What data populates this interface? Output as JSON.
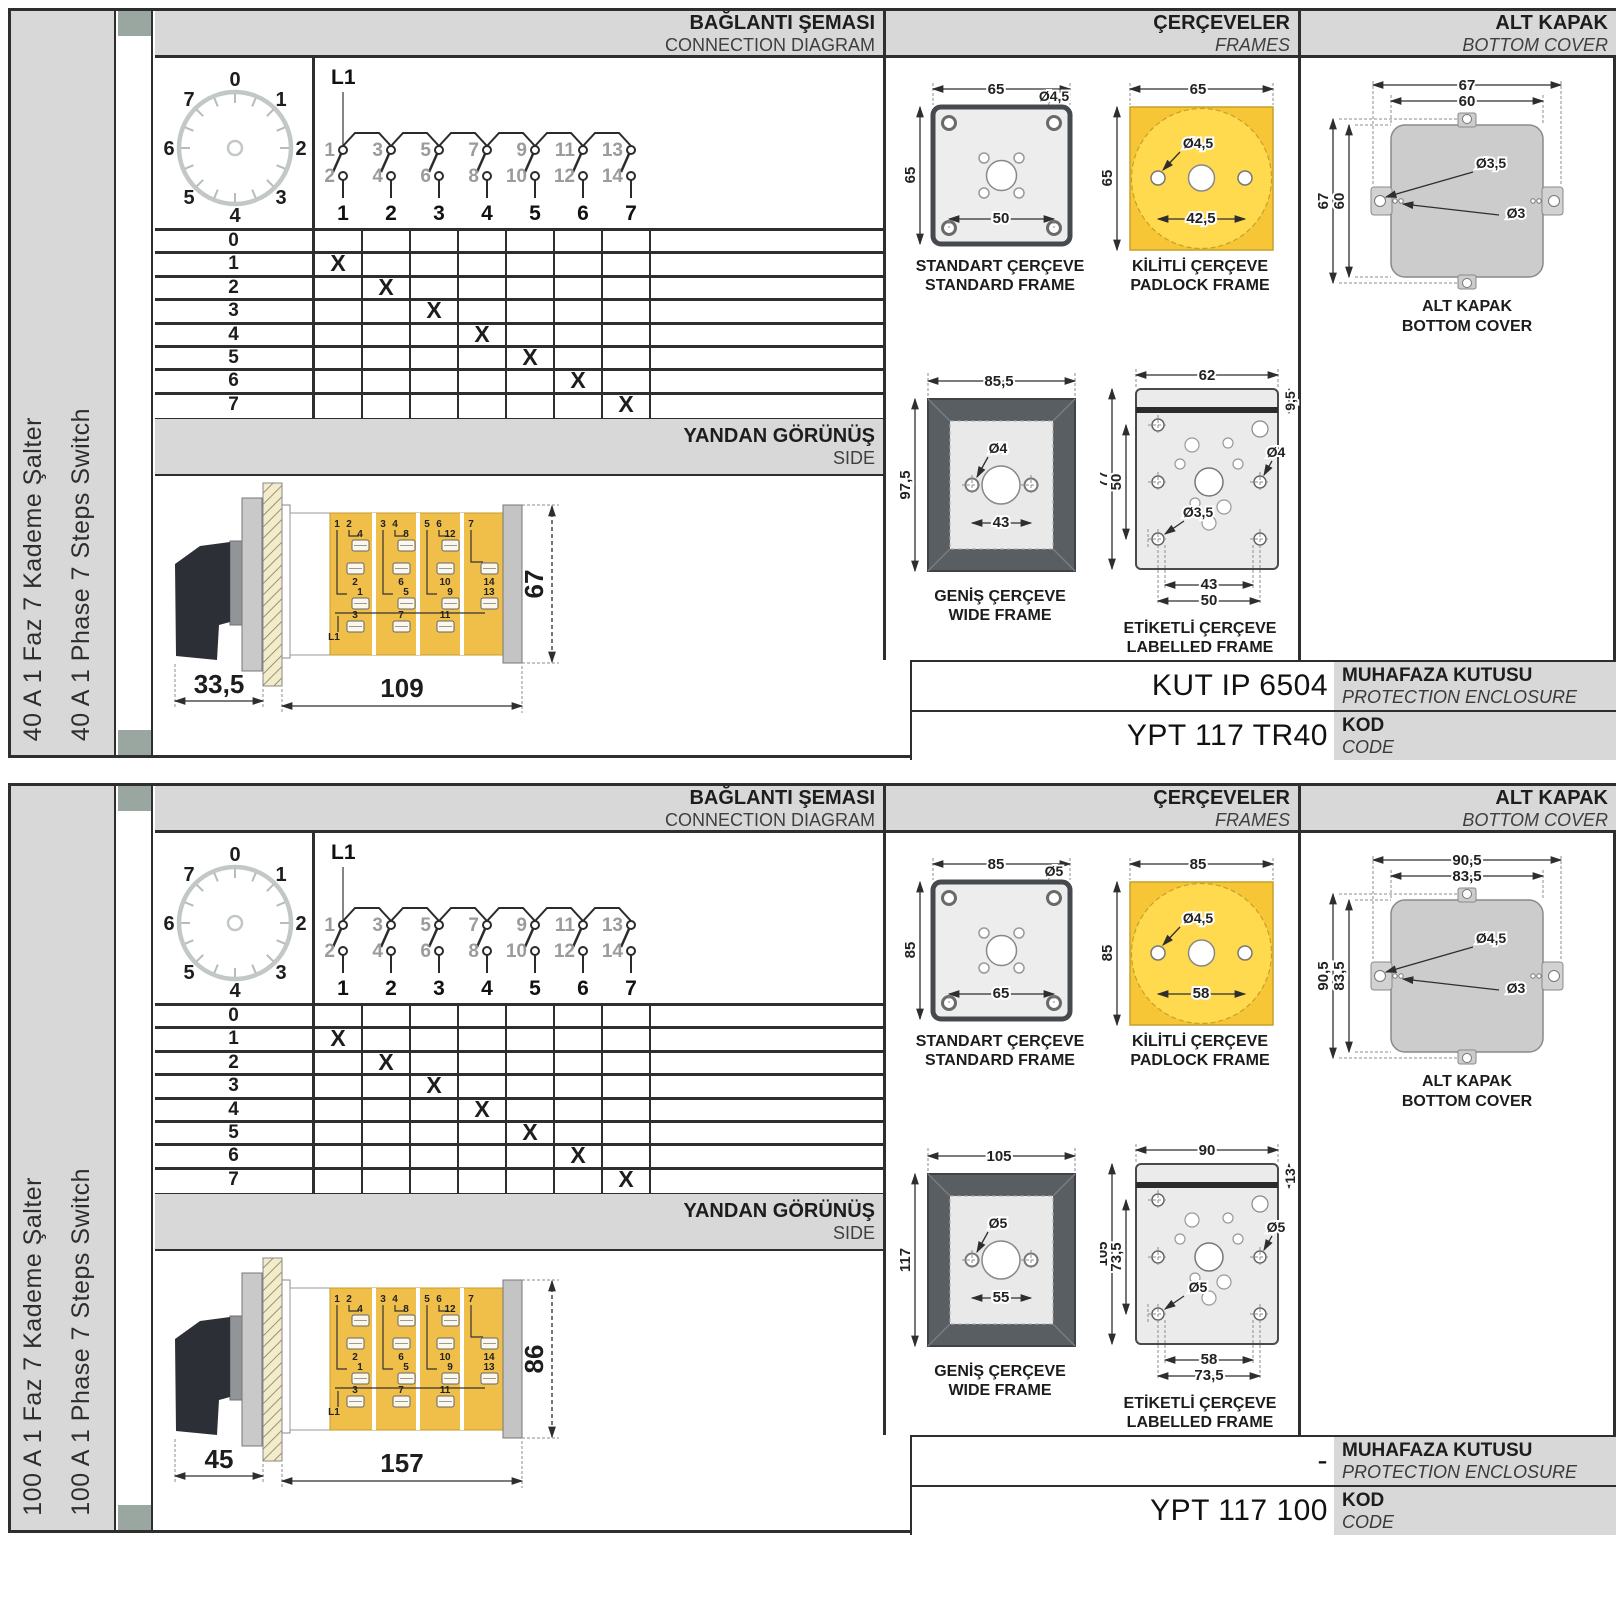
{
  "shared": {
    "header": {
      "connection_tr": "BAĞLANTI ŞEMASI",
      "connection_en": "CONNECTION DIAGRAM",
      "frames_tr": "ÇERÇEVELER",
      "frames_en": "FRAMES",
      "cover_tr": "ALT KAPAK",
      "cover_en": "BOTTOM COVER"
    },
    "side_band": {
      "tr": "YANDAN GÖRÜNÜŞ",
      "en": "SIDE"
    },
    "dial": {
      "labels": [
        "0",
        "1",
        "2",
        "3",
        "4",
        "5",
        "6",
        "7"
      ]
    },
    "schematic": {
      "l1": "L1",
      "top": [
        "1",
        "3",
        "5",
        "7",
        "9",
        "11",
        "13"
      ],
      "bottom": [
        "2",
        "4",
        "6",
        "8",
        "10",
        "12",
        "14"
      ],
      "outputs": [
        "1",
        "2",
        "3",
        "4",
        "5",
        "6",
        "7"
      ]
    },
    "table": {
      "rows": [
        "0",
        "1",
        "2",
        "3",
        "4",
        "5",
        "6",
        "7"
      ],
      "x": "X"
    },
    "captions": {
      "standard_tr": "STANDART ÇERÇEVE",
      "standard_en": "STANDARD FRAME",
      "padlock_tr": "KİLİTLİ ÇERÇEVE",
      "padlock_en": "PADLOCK FRAME",
      "wide_tr": "GENİŞ ÇERÇEVE",
      "wide_en": "WIDE FRAME",
      "labelled_tr": "ETİKETLİ ÇERÇEVE",
      "labelled_en": "LABELLED FRAME",
      "cover_tr": "ALT KAPAK",
      "cover_en": "BOTTOM COVER"
    },
    "code_rows": {
      "enclosure_tr": "MUHAFAZA KUTUSU",
      "enclosure_en": "PROTECTION ENCLOSURE",
      "code_tr": "KOD",
      "code_en": "CODE"
    },
    "body": {
      "pairs": [
        "1",
        "2",
        "3",
        "4",
        "5",
        "6",
        "7"
      ],
      "upper": [
        "4",
        "8",
        "12"
      ],
      "mid": [
        "2",
        "6",
        "10",
        "14"
      ],
      "low": [
        "1",
        "5",
        "9",
        "13"
      ],
      "bot": [
        "3",
        "7",
        "11"
      ],
      "l1": "L1"
    },
    "colors": {
      "accent_yellow": "#f2c53d",
      "band_gray": "#d8d8d8",
      "line_dark": "#2b2b2b"
    }
  },
  "sections": [
    {
      "title_tr": "40 A 1 Faz 7 Kademe Şalter",
      "title_en": "40 A 1 Phase 7 Steps Switch",
      "side_dims": {
        "handle": "33,5",
        "body": "109",
        "height": "67"
      },
      "standard": {
        "w": "65",
        "hole": "Ø4,5",
        "h": "65",
        "inner": "50"
      },
      "padlock": {
        "w": "65",
        "hole": "Ø4,5",
        "h": "65",
        "inner": "42,5"
      },
      "wide": {
        "w": "85,5",
        "hole": "Ø4",
        "h": "97,5",
        "inner": "43"
      },
      "labelled": {
        "w": "62",
        "band": "9,5",
        "h": "77",
        "inner_h": "50",
        "hole_right": "Ø4",
        "hole_left": "Ø3,5",
        "w1": "43",
        "w2": "50"
      },
      "cover": {
        "w1": "67",
        "w2": "60",
        "h1": "67",
        "h2": "60",
        "hole1": "Ø3,5",
        "hole2": "Ø3"
      },
      "enclosure": "KUT IP 6504",
      "code": "YPT 117 TR40"
    },
    {
      "title_tr": "100 A 1 Faz 7 Kademe Şalter",
      "title_en": "100 A 1 Phase 7 Steps Switch",
      "side_dims": {
        "handle": "45",
        "body": "157",
        "height": "86"
      },
      "standard": {
        "w": "85",
        "hole": "Ø5",
        "h": "85",
        "inner": "65"
      },
      "padlock": {
        "w": "85",
        "hole": "Ø4,5",
        "h": "85",
        "inner": "58"
      },
      "wide": {
        "w": "105",
        "hole": "Ø5",
        "h": "117",
        "inner": "55"
      },
      "labelled": {
        "w": "90",
        "band": "13",
        "h": "105",
        "inner_h": "73,5",
        "hole_right": "Ø5",
        "hole_left": "Ø5",
        "w1": "58",
        "w2": "73,5"
      },
      "cover": {
        "w1": "90,5",
        "w2": "83,5",
        "h1": "90,5",
        "h2": "83,5",
        "hole1": "Ø4,5",
        "hole2": "Ø3"
      },
      "enclosure": "-",
      "code": "YPT 117 100"
    }
  ]
}
